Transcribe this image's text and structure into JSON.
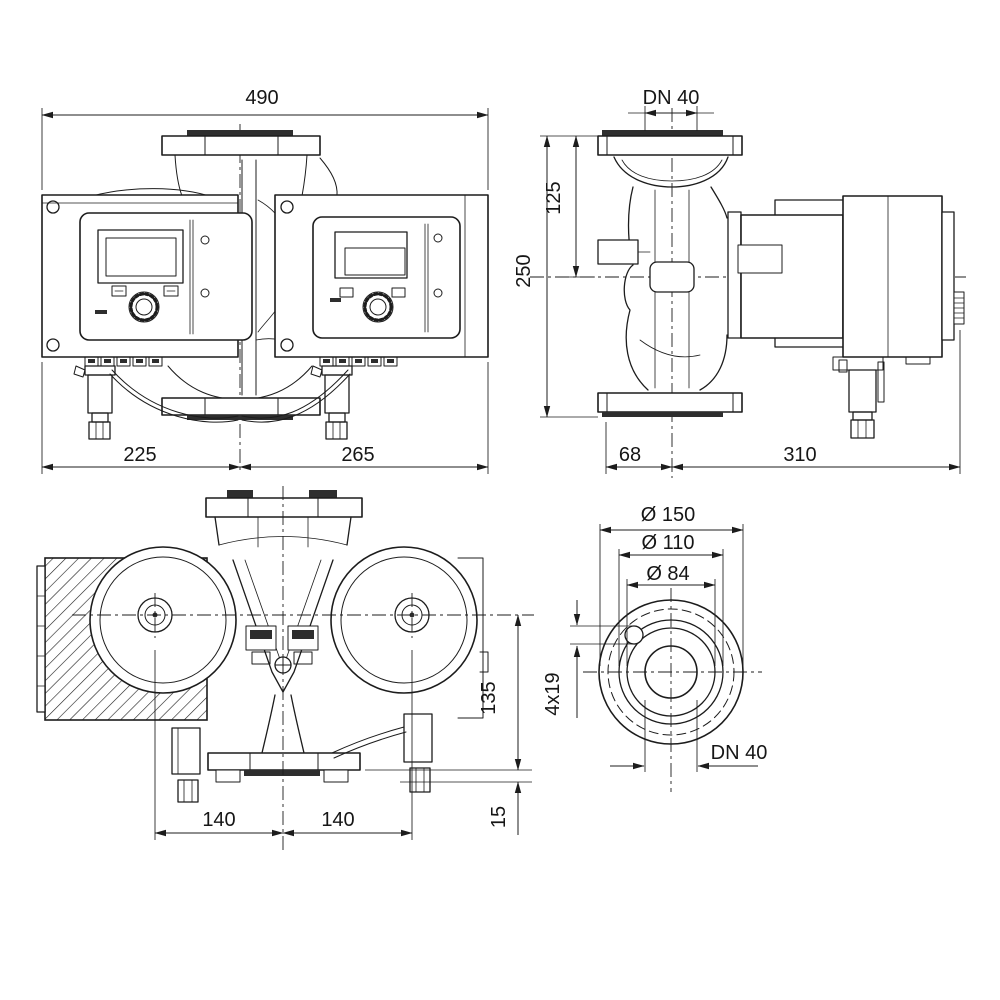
{
  "title": "pump-dimensional-drawing",
  "colors": {
    "line": "#1c1c1c",
    "dark_fill": "#2e2e2e",
    "background": "#ffffff"
  },
  "views": {
    "front": {
      "total_width": "490",
      "left_width": "225",
      "right_width": "265"
    },
    "side": {
      "flange_dn": "DN 40",
      "port_to_axis": "125",
      "port_to_port": "250",
      "axis_to_front": "68",
      "axis_to_back": "310"
    },
    "top": {
      "left_pitch": "140",
      "right_pitch": "140",
      "axis_to_flange": "135",
      "flange_foot": "15"
    },
    "flange": {
      "outer_dia": "Ø 150",
      "bolt_circle_dia": "Ø 110",
      "hub_dia": "Ø 84",
      "bolt_holes": "4x19",
      "nominal": "DN 40"
    }
  }
}
